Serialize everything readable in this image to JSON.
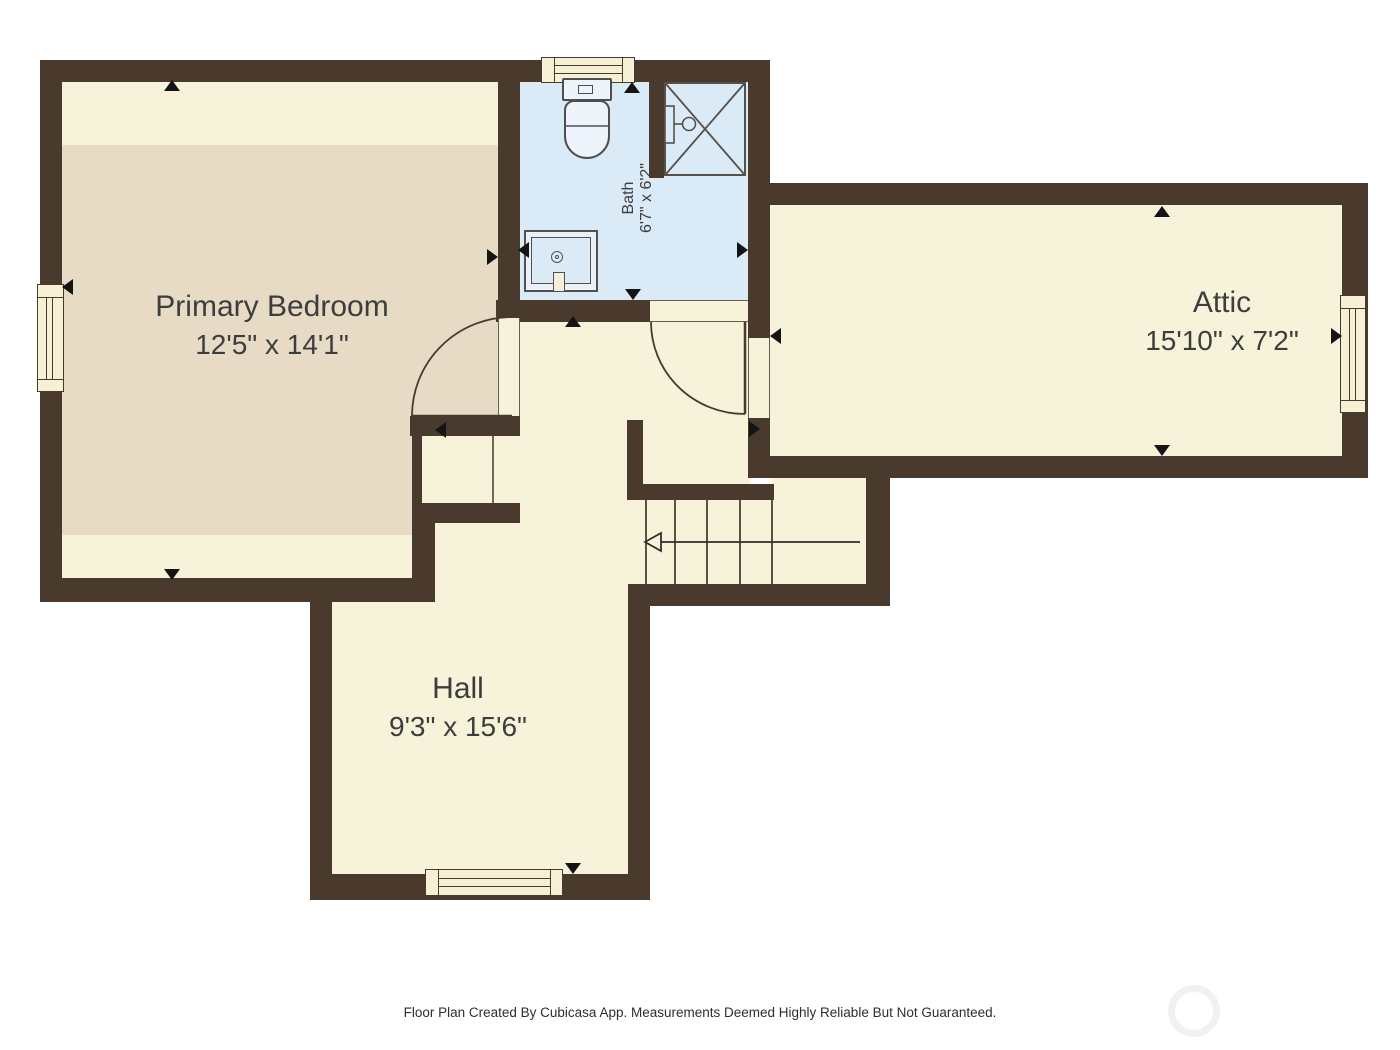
{
  "footer": {
    "text": "Floor Plan Created By Cubicasa App. Measurements Deemed Highly Reliable But Not Guaranteed."
  },
  "rooms": {
    "primary_bedroom": {
      "name": "Primary Bedroom",
      "dimensions": "12'5\" x 14'1\""
    },
    "bath": {
      "name": "Bath",
      "dimensions": "6'7\" x 6'2\""
    },
    "attic": {
      "name": "Attic",
      "dimensions": "15'10\" x 7'2\""
    },
    "hall": {
      "name": "Hall",
      "dimensions": "9'3\" x 15'6\""
    }
  },
  "colors": {
    "wall": "#4a392d",
    "floor": "#f6f3da",
    "carpet": "#e8dbc5",
    "bath_floor": "#daeaf7",
    "window_fill": "#f6f1d5",
    "fixture_line": "#4e4e4e",
    "arrow": "#141414"
  },
  "fixtures": [
    "toilet",
    "shower",
    "sink",
    "stairs",
    "windows",
    "doors"
  ],
  "stairs": {
    "treads": 4,
    "direction": "down-left"
  }
}
